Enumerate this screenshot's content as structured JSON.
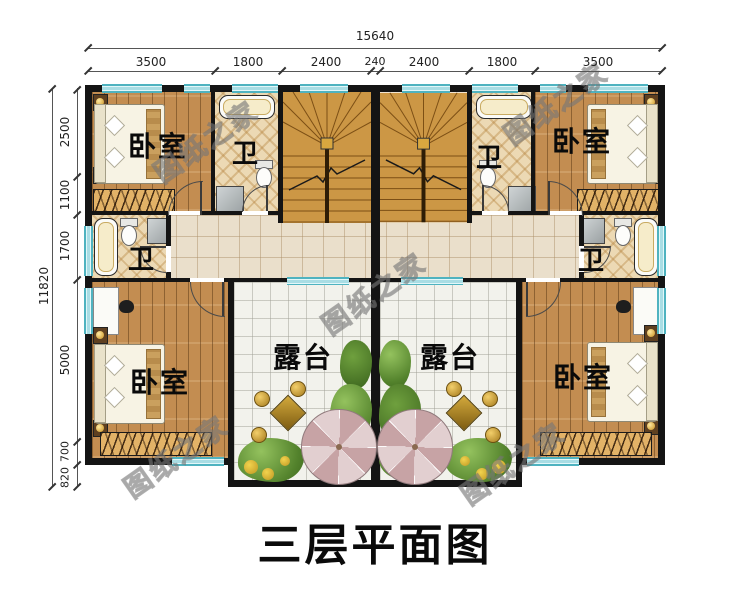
{
  "title": "三层平面图",
  "watermark_text": "图纸之家",
  "dimensions": {
    "top_total": "15640",
    "top_segments": [
      "3500",
      "1800",
      "2400",
      "240",
      "2400",
      "1800",
      "3500"
    ],
    "left_total": "11820",
    "left_segments": [
      "2500",
      "1100",
      "1700",
      "5000",
      "700",
      "820"
    ]
  },
  "room_labels": {
    "bedroom": "卧室",
    "bathroom": "卫",
    "terrace": "露台"
  },
  "colors": {
    "wall": "#141414",
    "window": "#a9dde4",
    "wood_floor": "#c38d51",
    "stair_wood": "#cc9745",
    "corridor_tile": "#eadfcb",
    "terrace_tile": "#f2f2ec",
    "bath_tile": "#ecd9b4",
    "umbrella": "#c7a3a5",
    "plant": "#53822c",
    "title_text": "#0a0a0a"
  }
}
